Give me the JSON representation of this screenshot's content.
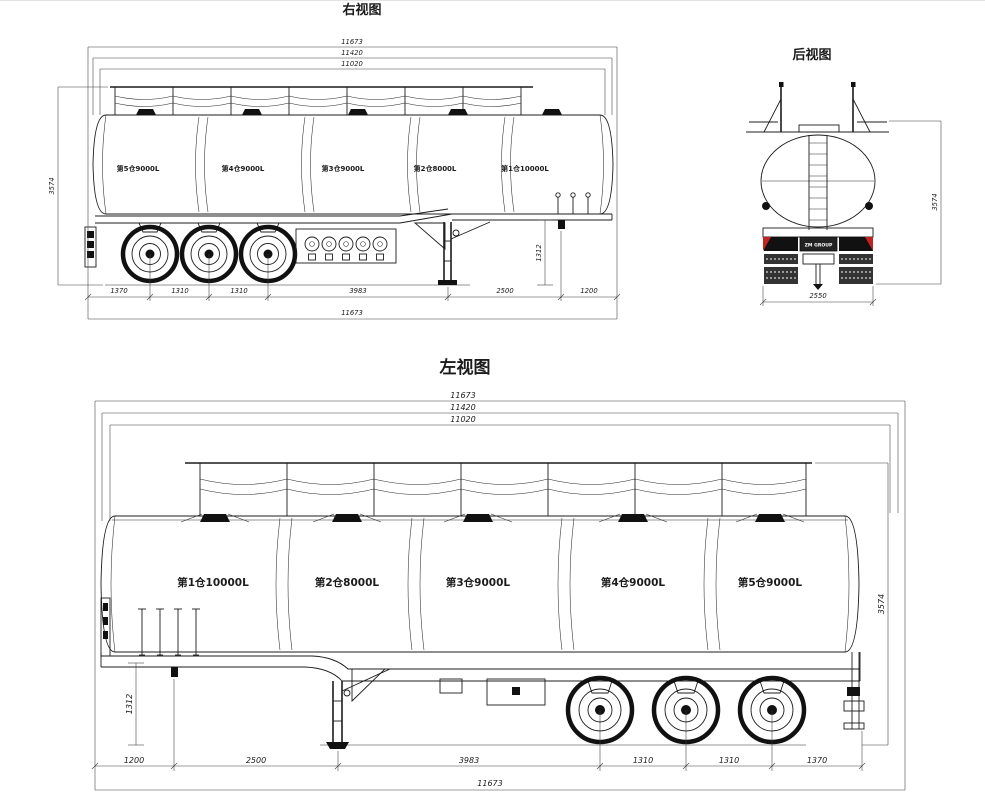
{
  "colors": {
    "line": "#1c1c1c",
    "background": "#ffffff",
    "accent_red": "#c32222"
  },
  "right_view": {
    "title": "右视图",
    "top_dims": [
      "11673",
      "11420",
      "11020"
    ],
    "compartments": [
      "第5仓9000L",
      "第4仓9000L",
      "第3仓9000L",
      "第2仓8000L",
      "第1仓10000L"
    ],
    "height_dim": "3574",
    "leg_height_dim": "1312",
    "bottom_dims": [
      "1370",
      "1310",
      "1310",
      "3983",
      "2500",
      "1200"
    ],
    "overall_dim": "11673"
  },
  "rear_view": {
    "title": "后视图",
    "width_dim": "2550",
    "height_dim": "3574",
    "brand": "ZM GROUP"
  },
  "left_view": {
    "title": "左视图",
    "top_dims": [
      "11673",
      "11420",
      "11020"
    ],
    "compartments": [
      "第1仓10000L",
      "第2仓8000L",
      "第3仓9000L",
      "第4仓9000L",
      "第5仓9000L"
    ],
    "height_dim": "3574",
    "leg_height_dim": "1312",
    "bottom_dims": [
      "1200",
      "2500",
      "3983",
      "1310",
      "1310",
      "1370"
    ],
    "overall_dim": "11673"
  }
}
